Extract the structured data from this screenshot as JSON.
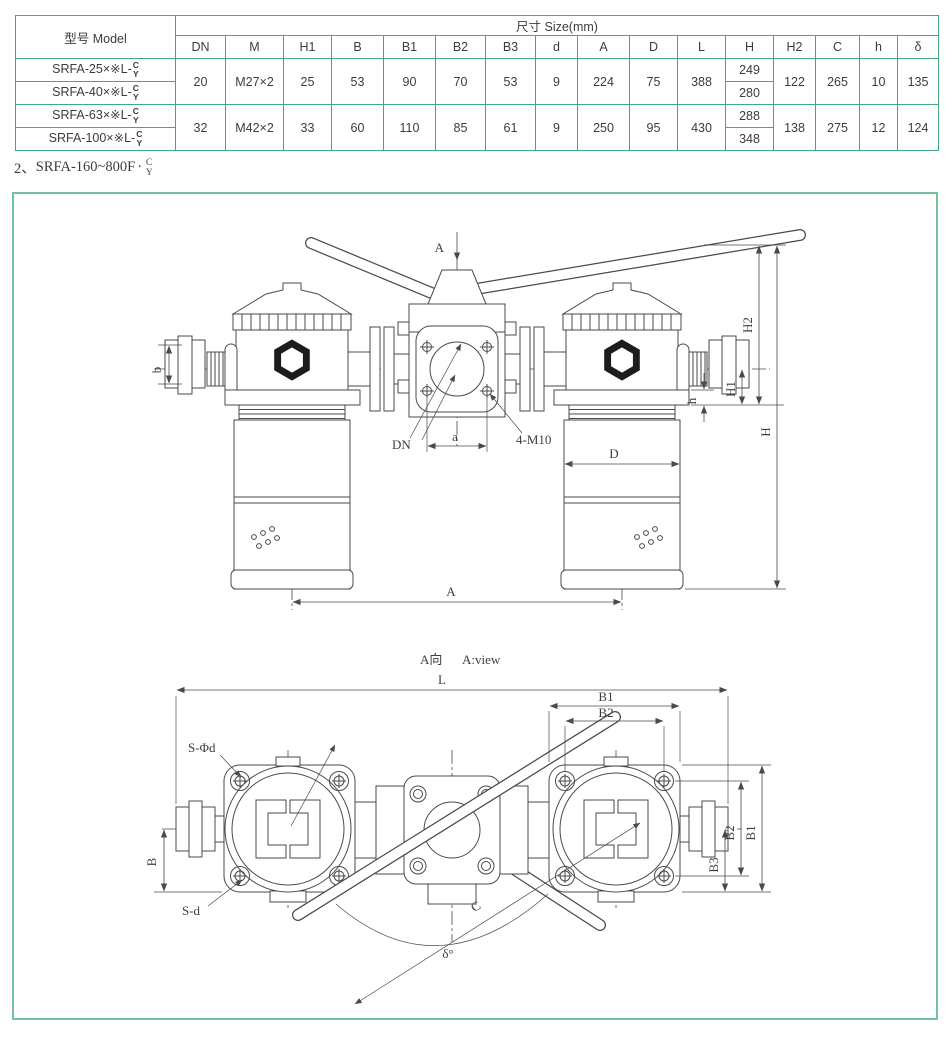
{
  "table": {
    "model_header": "型号 Model",
    "size_header": "尺寸 Size(mm)",
    "columns": [
      "DN",
      "M",
      "H1",
      "B",
      "B1",
      "B2",
      "B3",
      "d",
      "A",
      "D",
      "L",
      "H",
      "H2",
      "C",
      "h",
      "δ"
    ],
    "models": {
      "m25": "SRFA-25×※L-",
      "m40": "SRFA-40×※L-",
      "m63": "SRFA-63×※L-",
      "m100": "SRFA-100×※L-"
    },
    "suffix_top": "C",
    "suffix_bottom": "Y",
    "g1": {
      "dn": "20",
      "m": "M27×2",
      "h1": "25",
      "b": "53",
      "b1": "90",
      "b2": "70",
      "b3": "53",
      "d": "9",
      "a": "224",
      "dcap": "75",
      "l": "388",
      "h_row1": "249",
      "h_row2": "280",
      "h2": "122",
      "c": "265",
      "hs": "10",
      "delta": "135"
    },
    "g2": {
      "dn": "32",
      "m": "M42×2",
      "h1": "33",
      "b": "60",
      "b1": "110",
      "b2": "85",
      "b3": "61",
      "d": "9",
      "a": "250",
      "dcap": "95",
      "l": "430",
      "h_row1": "288",
      "h_row2": "348",
      "h2": "138",
      "c": "275",
      "hs": "12",
      "delta": "124"
    }
  },
  "note": {
    "index": "2、",
    "text": "SRFA-160~800F",
    "sep": "·",
    "top": "C",
    "bottom": "Y"
  },
  "diagram": {
    "front": {
      "view_arrow": "A",
      "dim_b": "b",
      "dim_h2": "H2",
      "dim_h1": "H1",
      "dim_h_small": "h",
      "dim_h": "H",
      "dim_a_small": "a",
      "label_dn": "DN",
      "label_bolts": "4-M10",
      "dim_d": "D",
      "dim_a": "A"
    },
    "top": {
      "view_cn": "A向",
      "view_en": "A:view",
      "dim_l": "L",
      "dim_b1_h": "B1",
      "dim_b2_h": "B2",
      "label_s_phi_d": "S-Φd",
      "label_s_d": "S-d",
      "dim_b": "B",
      "dim_b2_v": "B2",
      "dim_b1_v": "B1",
      "dim_b3": "B3",
      "dim_c": "C",
      "dim_delta": "δ°"
    }
  },
  "colors": {
    "table_border": "#44a878",
    "header_bg": "#ddefe3",
    "row_alt_bg": "#e4f2e8",
    "frame_border": "#72c39b",
    "line": "#4a4a4a"
  }
}
